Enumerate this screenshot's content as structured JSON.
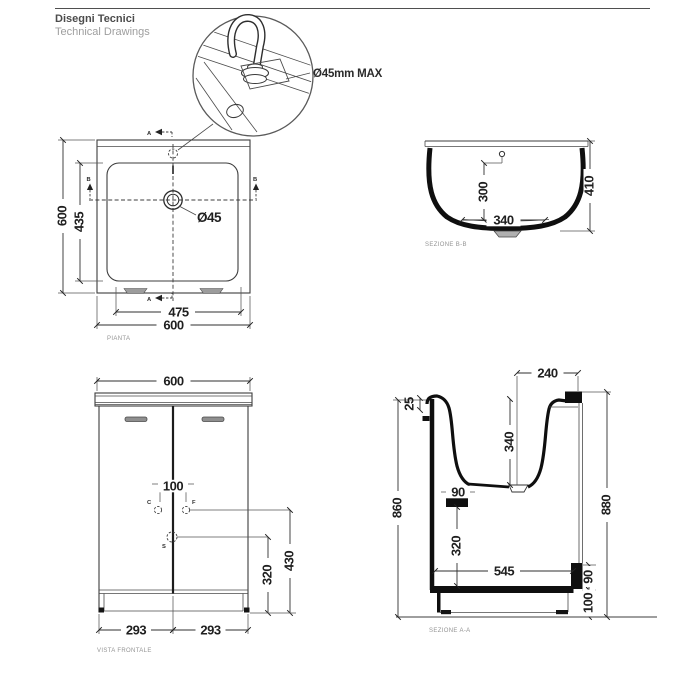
{
  "header": {
    "title_it": "Disegni Tecnici",
    "title_en": "Technical Drawings"
  },
  "detail": {
    "callout": "Ø45mm MAX"
  },
  "plan": {
    "label": "PIANTA",
    "mark_a": "A",
    "mark_b": "B",
    "drain_label": "Ø45",
    "dims": {
      "outer_height": "600",
      "inner_height": "435",
      "inner_width": "475",
      "outer_width": "600"
    }
  },
  "section_bb": {
    "label": "SEZIONE B-B",
    "dims": {
      "depth_to_overflow": "300",
      "bottom_width": "340",
      "total_height": "410"
    }
  },
  "front": {
    "label": "VISTA FRONTALE",
    "mark_c": "C",
    "mark_f": "F",
    "mark_s": "S",
    "dims": {
      "width": "600",
      "tap_spacing": "100",
      "supply_height": "430",
      "waste_height": "320",
      "door_left": "293",
      "door_right": "293"
    }
  },
  "section_aa": {
    "label": "SEZIONE A-A",
    "dims": {
      "basin_front_offset": "240",
      "rim": "25",
      "basin_depth": "340",
      "waste_outlet": "90",
      "outlet_height": "320",
      "inner_depth": "545",
      "front_height": "860",
      "back_height": "880",
      "back_clearance": "90",
      "plinth_height": "100"
    }
  }
}
